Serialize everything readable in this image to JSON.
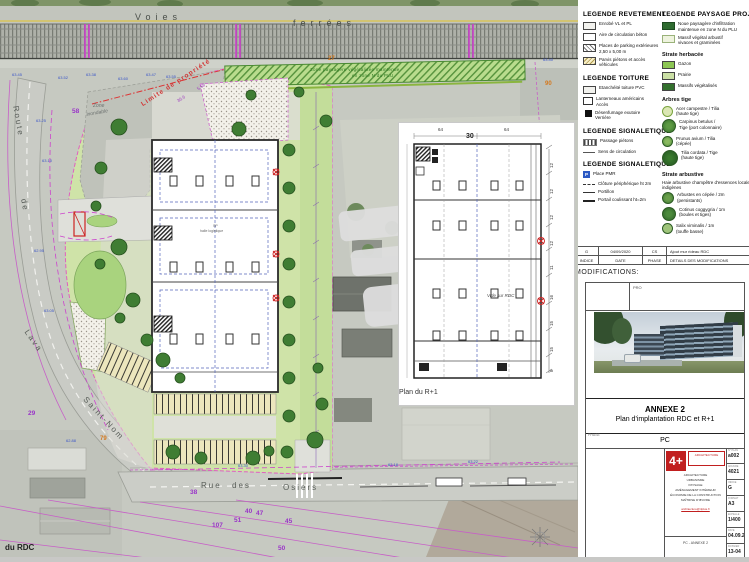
{
  "colors": {
    "accent_red": "#c11f1f",
    "cadastre_magenta": "#c75fc7",
    "landscape_green": "#cfe3a8"
  },
  "site_plan": {
    "labels": [
      {
        "t": "Voies",
        "x": 135,
        "y": 12,
        "c": "rail"
      },
      {
        "t": "ferrées",
        "x": 293,
        "y": 18,
        "c": "rail"
      },
      {
        "t": "Route",
        "x": 20,
        "y": 105,
        "c": "street",
        "r": 80
      },
      {
        "t": "de",
        "x": 28,
        "y": 198,
        "c": "street",
        "r": 80
      },
      {
        "t": "Lava",
        "x": 30,
        "y": 328,
        "c": "street",
        "r": 55
      },
      {
        "t": "Saint-Nom",
        "x": 88,
        "y": 395,
        "c": "street",
        "r": 47
      },
      {
        "t": "Rue",
        "x": 201,
        "y": 481,
        "c": "street"
      },
      {
        "t": "des",
        "x": 232,
        "y": 481,
        "c": "street"
      },
      {
        "t": "Osiers",
        "x": 283,
        "y": 483,
        "c": "street"
      },
      {
        "t": "Zone paysagère végétalisée maintenue",
        "x": 310,
        "y": 67,
        "c": "green"
      },
      {
        "t": "en zone N du PLU",
        "x": 352,
        "y": 73,
        "c": "green"
      },
      {
        "t": "Limite de propriété",
        "x": 140,
        "y": 102,
        "c": "limite",
        "r": -33
      },
      {
        "t": "36.6",
        "x": 176,
        "y": 99,
        "c": "dimp",
        "r": -33
      },
      {
        "t": "5.58",
        "x": 196,
        "y": 87,
        "c": "dimp",
        "r": -33
      },
      {
        "t": "Zone",
        "x": 93,
        "y": 103,
        "c": "zone"
      },
      {
        "t": "inondable",
        "x": 86,
        "y": 112,
        "c": "zone",
        "r": -10
      },
      {
        "t": "58",
        "x": 72,
        "y": 108,
        "c": "parcel"
      },
      {
        "t": "29",
        "x": 28,
        "y": 410,
        "c": "parcel"
      },
      {
        "t": "38",
        "x": 190,
        "y": 489,
        "c": "parcel"
      },
      {
        "t": "107",
        "x": 212,
        "y": 522,
        "c": "parcel"
      },
      {
        "t": "51",
        "x": 234,
        "y": 517,
        "c": "parcel"
      },
      {
        "t": "40",
        "x": 245,
        "y": 508,
        "c": "parcel"
      },
      {
        "t": "47",
        "x": 256,
        "y": 510,
        "c": "parcel"
      },
      {
        "t": "45",
        "x": 285,
        "y": 518,
        "c": "parcel"
      },
      {
        "t": "50",
        "x": 278,
        "y": 545,
        "c": "parcel"
      },
      {
        "t": "27",
        "x": 328,
        "y": 56,
        "c": "pnum"
      },
      {
        "t": "79",
        "x": 100,
        "y": 436,
        "c": "pnum"
      },
      {
        "t": "90",
        "x": 545,
        "y": 81,
        "c": "pnum"
      },
      {
        "t": "63.45",
        "x": 12,
        "y": 72,
        "c": "elev"
      },
      {
        "t": "63.52",
        "x": 58,
        "y": 75,
        "c": "elev"
      },
      {
        "t": "63.38",
        "x": 86,
        "y": 72,
        "c": "elev"
      },
      {
        "t": "63.60",
        "x": 118,
        "y": 76,
        "c": "elev"
      },
      {
        "t": "63.47",
        "x": 146,
        "y": 72,
        "c": "elev"
      },
      {
        "t": "63.55",
        "x": 166,
        "y": 74,
        "c": "elev"
      },
      {
        "t": "63.25",
        "x": 36,
        "y": 118,
        "c": "elev"
      },
      {
        "t": "63.10",
        "x": 42,
        "y": 158,
        "c": "elev"
      },
      {
        "t": "62.95",
        "x": 34,
        "y": 248,
        "c": "elev"
      },
      {
        "t": "63.05",
        "x": 44,
        "y": 308,
        "c": "elev"
      },
      {
        "t": "62.88",
        "x": 66,
        "y": 438,
        "c": "elev"
      },
      {
        "t": "63.30",
        "x": 238,
        "y": 463,
        "c": "elev"
      },
      {
        "t": "63.18",
        "x": 388,
        "y": 462,
        "c": "elev"
      },
      {
        "t": "63.22",
        "x": 468,
        "y": 459,
        "c": "elev"
      },
      {
        "t": "63.40",
        "x": 543,
        "y": 57,
        "c": "elev"
      },
      {
        "t": "SP",
        "x": 213,
        "y": 224,
        "c": "micro"
      },
      {
        "t": "halle logistique",
        "x": 200,
        "y": 229,
        "c": "micro"
      },
      {
        "t": "64",
        "x": 438,
        "y": 127,
        "c": "dim"
      },
      {
        "t": "30",
        "x": 466,
        "y": 133,
        "c": "dimbig"
      },
      {
        "t": "64",
        "x": 504,
        "y": 127,
        "c": "dim"
      },
      {
        "t": "12",
        "x": 549,
        "y": 168,
        "c": "dim",
        "r": -90
      },
      {
        "t": "12",
        "x": 549,
        "y": 194,
        "c": "dim",
        "r": -90
      },
      {
        "t": "12",
        "x": 549,
        "y": 220,
        "c": "dim",
        "r": -90
      },
      {
        "t": "12",
        "x": 549,
        "y": 246,
        "c": "dim",
        "r": -90
      },
      {
        "t": "11",
        "x": 549,
        "y": 270,
        "c": "dim",
        "r": -90
      },
      {
        "t": "16",
        "x": 549,
        "y": 300,
        "c": "dim",
        "r": -90
      },
      {
        "t": "15",
        "x": 549,
        "y": 326,
        "c": "dim",
        "r": -90
      },
      {
        "t": "15",
        "x": 549,
        "y": 352,
        "c": "dim",
        "r": -90
      },
      {
        "t": "8",
        "x": 549,
        "y": 372,
        "c": "dim",
        "r": -90
      },
      {
        "t": "Vide sur RDC",
        "x": 487,
        "y": 293,
        "c": "note"
      },
      {
        "t": "Plan du R+1",
        "x": 399,
        "y": 389,
        "c": "cap"
      },
      {
        "t": "du RDC",
        "x": 5,
        "y": 543,
        "c": "cap2"
      }
    ]
  },
  "legends": {
    "revetement": {
      "title": "LEGENDE REVETEMENT",
      "items": [
        {
          "s": "sw sw-a",
          "l1": "Enrobé VL et PL"
        },
        {
          "s": "sw sw-b",
          "l1": "Aire de circulation béton"
        },
        {
          "s": "sw sw-c",
          "l1": "Places de parking extérieures",
          "l2": "2,50 x 5,00 m"
        },
        {
          "s": "sw sw-d",
          "l1": "Parvis piétons et accès véhicules"
        }
      ]
    },
    "toiture": {
      "title": "LEGENDE TOITURE",
      "items": [
        {
          "s": "sw sw-a",
          "l1": "Etanchéité toiture PVC"
        },
        {
          "s": "sw sw-open",
          "l1": "Lanterneaux américains",
          "l2": "Accès"
        },
        {
          "s": "sw sw-fill",
          "l1": "Désenfumage exutoire",
          "l2": "Verrière"
        }
      ]
    },
    "signaletique1": {
      "title": "LEGENDE SIGNALETIQUE",
      "items": [
        {
          "s": "ic-zebra",
          "l1": "Passage piétons"
        },
        {
          "s": "ic-line",
          "l1": "Sens de circulation"
        }
      ]
    },
    "signaletique2": {
      "title": "LEGENDE SIGNALETIQUE",
      "items": [
        {
          "s": "ic-pmr",
          "g": "P",
          "l1": "Place PMR"
        },
        {
          "s": "ic-fence",
          "l1": "Clôture périphérique ht 2m"
        },
        {
          "s": "ic-gate",
          "l1": "Portillon"
        },
        {
          "s": "ic-slide",
          "l1": "Portail coulissant ht=2m"
        }
      ]
    },
    "paysage": {
      "title": "LEGENDE PAYSAGE PROJET",
      "items": [
        {
          "s": "sw sw-dgreen",
          "l1": "Noue paysagère d'infiltration",
          "l2": "maintenue en zone N du PLU"
        },
        {
          "s": "sw sw-pale",
          "l1": "Massif végétal arbustif",
          "l2": "vivaces et graminées"
        }
      ],
      "herbacee": {
        "title": "Strate herbacée",
        "items": [
          {
            "s": "sw sw-g1",
            "l1": "Gazon"
          },
          {
            "s": "sw sw-g2",
            "l1": "Prairie"
          },
          {
            "s": "sw sw-g3",
            "l1": "Massifs végétalisés"
          }
        ]
      },
      "arbres": {
        "title": "Arbres tige",
        "items": [
          {
            "s": "tc tc1",
            "l1": "Acer campestre / Tilia",
            "l2": "(haute tige)"
          },
          {
            "s": "tc tc2",
            "l1": "Carpinus betulus /",
            "l2": "Tige (port colonnaire)"
          },
          {
            "s": "tc tc3",
            "l1": "Prunus avium / Tilia",
            "l2": "(cépée)"
          },
          {
            "s": "tc tc4",
            "l1": "Tilia cordata / Tige",
            "l2": "(haute tige)"
          }
        ]
      },
      "arbustive": {
        "title": "Strate arbustive",
        "note": "Haie arbustive champêtre d'essences locales indigènes",
        "items": [
          {
            "s": "tc tc5",
            "l1": "Arbustes en cépée / 2m",
            "l2": "(persistants)"
          },
          {
            "s": "tc tc6",
            "l1": "Cotinus coggygria / 1m",
            "l2": "(boules et tiges)"
          },
          {
            "s": "tc tc7",
            "l1": "Salix viminalis / 1m",
            "l2": "(touffe basse)"
          }
        ]
      }
    }
  },
  "titleblock": {
    "modifications": {
      "caption": "MODIFICATIONS:",
      "rows": [
        [
          "G",
          "04/09/2020",
          "CS",
          "Ajout mur rideau RDC"
        ],
        [
          "INDICE",
          "DATE",
          "PHASE",
          "DETAILS DES MODIFICATIONS"
        ]
      ]
    },
    "pro_label": "PRO",
    "annexe": {
      "title": "ANNEXE 2",
      "subtitle": "Plan d'implantation RDC et R+1"
    },
    "phase": {
      "label": "PHASE",
      "value": "PC"
    },
    "logo": {
      "mark": "4+",
      "firm": "ARCHITECTURE",
      "lines": [
        "ARCHITECTURE",
        "URBANISME",
        "PAYSAGE",
        "AMÉNAGEMENT INTÉRIEUR",
        "ÉCONOMIE DE LA CONSTRUCTION",
        "MAÎTRISE D'ŒUVRE"
      ],
      "contact": "architecture@4plus.fr",
      "bottom_value": "PC - ANNEXE 2"
    },
    "fields": [
      {
        "label": "N° PLAN",
        "value": "a002"
      },
      {
        "label": "AFFAIRE",
        "value": "4021"
      },
      {
        "label": "INDICE",
        "value": "G"
      },
      {
        "label": "FORMAT",
        "value": "A3"
      },
      {
        "label": "ECHELLE",
        "value": "1/400"
      },
      {
        "label": "DATE",
        "value": "04.09.20"
      },
      {
        "label": "DOSSIER",
        "value": "13-04"
      }
    ]
  }
}
